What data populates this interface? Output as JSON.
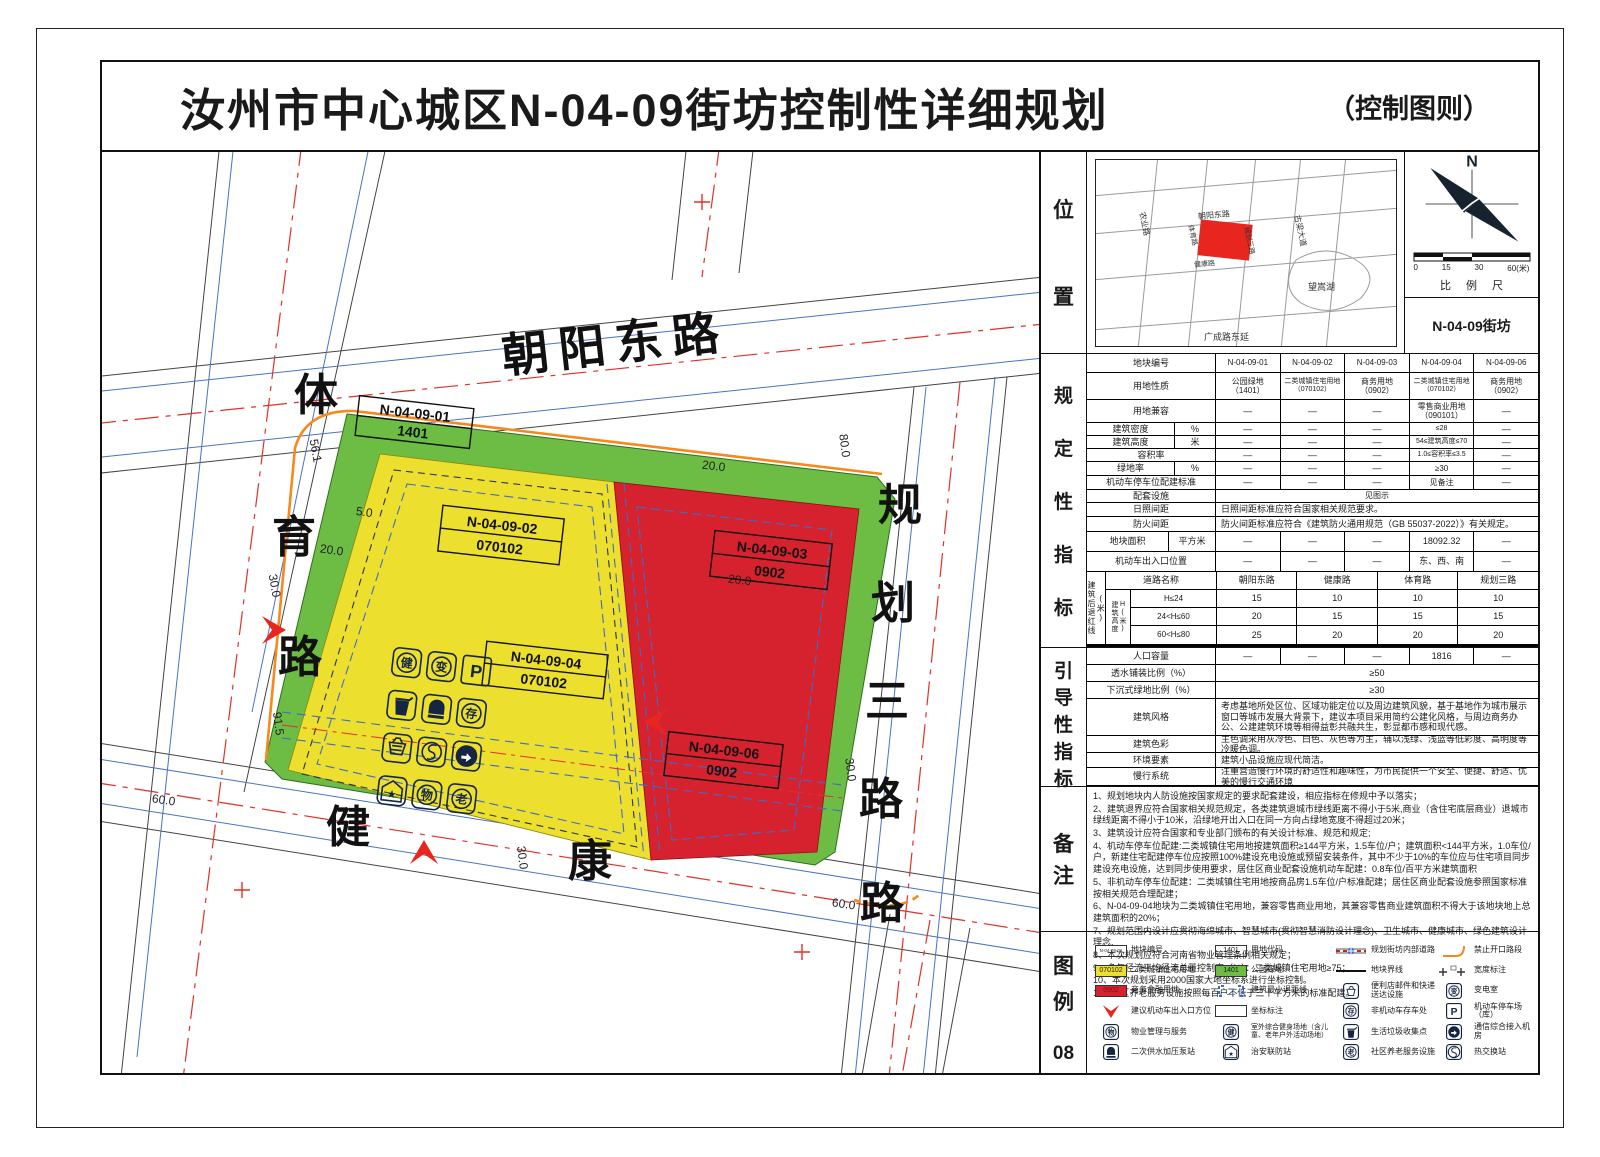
{
  "sheet": {
    "title": "汝州市中心城区N-04-09街坊控制性详细规划",
    "subtitle": "（控制图则）",
    "page_number": "08"
  },
  "map": {
    "road_north": "朝阳东路",
    "road_west_chars": [
      "体",
      "育",
      "路"
    ],
    "road_south_chars": [
      "健",
      "康",
      "路"
    ],
    "road_east_chars": [
      "规",
      "划",
      "三",
      "路"
    ],
    "parcels": [
      {
        "code": "N-04-09-01",
        "use": "1401"
      },
      {
        "code": "N-04-09-02",
        "use": "070102"
      },
      {
        "code": "N-04-09-03",
        "use": "0902"
      },
      {
        "code": "N-04-09-04",
        "use": "070102"
      },
      {
        "code": "N-04-09-06",
        "use": "0902"
      }
    ],
    "dims": [
      "80.0",
      "20.0",
      "20.0",
      "30.0",
      "60.0",
      "30.0",
      "60.0",
      "30.0",
      "20.0",
      "91.5",
      "56.1",
      "5.0"
    ],
    "icon_glyphs": {
      "fitness": "健",
      "transformer": "变",
      "parking": "P",
      "bike": "存",
      "property": "物",
      "elderly": "老",
      "star": "★"
    }
  },
  "location": {
    "label_chars": [
      "位",
      "置"
    ],
    "minimap": {
      "nongye": "农业路",
      "chaoyang": "朝阳东路",
      "tiyu": "体育路",
      "jiankang": "健康路",
      "guihua": "规划三路",
      "guliang": "古梁大道",
      "lake": "望嵩湖",
      "guangcheng": "广成路东延"
    },
    "compass_n": "N",
    "scale_ticks": [
      "0",
      "15",
      "30",
      "60(米)"
    ],
    "scale_label": "比 例 尺",
    "block_name": "N-04-09街坊"
  },
  "regulatory": {
    "label_chars": [
      "规",
      "定",
      "性",
      "指",
      "标"
    ],
    "plot_no": {
      "label": "地块编号",
      "values": [
        "N-04-09-01",
        "N-04-09-02",
        "N-04-09-03",
        "N-04-09-04",
        "N-04-09-06"
      ]
    },
    "land_use": {
      "label": "用地性质",
      "values": [
        "公园绿地\n（1401）",
        "二类城镇住宅用地\n（070102）",
        "商务用地\n（0902）",
        "二类城镇住宅用地\n（070102）",
        "商务用地\n（0902）"
      ]
    },
    "compat": {
      "label": "用地兼容",
      "values": [
        "—",
        "—",
        "—",
        "零售商业用地\n（090101）",
        "—"
      ]
    },
    "density": {
      "label": "建筑密度",
      "unit": "%",
      "values": [
        "—",
        "—",
        "—",
        "≤28",
        "—"
      ]
    },
    "height": {
      "label": "建筑高度",
      "unit": "米",
      "values": [
        "—",
        "—",
        "—",
        "54≤建筑高度≤70",
        "—"
      ]
    },
    "far": {
      "label": "容积率",
      "values": [
        "—",
        "—",
        "—",
        "1.0≤容积率≤3.5",
        "—"
      ]
    },
    "green": {
      "label": "绿地率",
      "unit": "%",
      "values": [
        "—",
        "—",
        "—",
        "≥30",
        "—"
      ]
    },
    "parking": {
      "label": "机动车停车位配建标准",
      "values": [
        "—",
        "—",
        "—",
        "见备注",
        "—"
      ]
    },
    "facilities": {
      "label": "配套设施",
      "value": "见图示"
    },
    "sunlight": {
      "label": "日照间距",
      "value": "日照间距标准应符合国家相关规范要求。"
    },
    "fire": {
      "label": "防火间距",
      "value": "防火间距标准应符合《建筑防火通用规范（GB 55037-2022）》有关规定。"
    },
    "area": {
      "label": "地块面积",
      "unit": "平方米",
      "values": [
        "—",
        "—",
        "—",
        "18092.32",
        "—"
      ]
    },
    "entrance": {
      "label": "机动车出入口位置",
      "values": [
        "—",
        "—",
        "—",
        "东、西、南",
        "—"
      ]
    },
    "setback": {
      "outer_label": "建筑后退红线(米)",
      "height_label": "建筑高度H(米)",
      "road_header": "道路名称",
      "roads": [
        "朝阳东路",
        "健康路",
        "体育路",
        "规划三路"
      ],
      "rows": [
        {
          "range": "H≤24",
          "values": [
            "15",
            "10",
            "10",
            "10"
          ]
        },
        {
          "range": "24<H≤60",
          "values": [
            "20",
            "15",
            "15",
            "15"
          ]
        },
        {
          "range": "60<H≤80",
          "values": [
            "25",
            "20",
            "20",
            "20"
          ]
        }
      ]
    }
  },
  "guidance": {
    "label_chars": [
      "引",
      "导",
      "性",
      "指",
      "标"
    ],
    "population": {
      "label": "人口容量",
      "values": [
        "—",
        "—",
        "—",
        "1816",
        "—"
      ]
    },
    "permeable": {
      "label": "透水铺装比例（%）",
      "value": "≥50"
    },
    "sunken": {
      "label": "下沉式绿地比例（%）",
      "value": "≥30"
    },
    "style": {
      "label": "建筑风格",
      "value": "考虑基地所处区位、区域功能定位以及周边建筑风貌，基于基地作为城市展示窗口等城市发展大背景下，建议本项目采用简约公建化风格，与周边商务办公、公建建筑环境等相得益彰共融共生，彰显都市感和现代感。"
    },
    "color": {
      "label": "建筑色彩",
      "value": "主色调采用灰冷色、白色、灰色等为主，辅以浅绿、浅蓝等低彩度、高明度等冷暖色调。"
    },
    "environment": {
      "label": "环境要素",
      "value": "建筑小品设施应现代简洁。"
    },
    "slow": {
      "label": "慢行系统",
      "value": "注重营造慢行环境的舒适性和趣味性，为市民提供一个安全、便捷、舒适、优美的慢行交通环境"
    }
  },
  "notes": {
    "label_chars": [
      "备",
      "注"
    ],
    "items": [
      "1、规划地块内人防设施按国家规定的要求配套建设，相应指标在修规中予以落实；",
      "2、建筑退界应符合国家相关规范规定，各类建筑退城市绿线距离不得小于5米,商业（含住宅底层商业）退城市绿线距离不得小于10米，沿绿地开出入口在同一方向占绿地宽度不得超过20米；",
      "3、建筑设计应符合国家和专业部门颁布的有关设计标准、规范和规定;",
      "4、机动车停车位配建:二类城镇住宅用地按建筑面积≥144平方米，1.5车位/户；建筑面积<144平方米，1.0车位/户，新建住宅配建停车位应按照100%建设充电设施或预留安装条件，其中不少于10%的车位应与住宅项目同步建设充电设施，达到同步使用要求，居住区商业配套设施机动车配建：0.8车位/百平方米建筑面积",
      "5、非机动车停车位配建：二类城镇住宅用地按商品房1.5车位/户标准配建；居住区商业配套设施参照国家标准按相关规范合理配建；",
      "6、N-04-09-04地块为二类城镇住宅用地，兼容零售商业用地，其兼容零售商业建筑面积不得大于该地块地上总建筑面积的20%；",
      "7、规划范围内设计应贯彻海绵城市、智慧城市(贯彻智慧消防设计理念)、卫生城市、健康城市、绿色建筑设计理念.",
      "8、本次规划应符合河南省物业管理条例相关规定；",
      "9、多年径流平均径流总量控制率（%）：二类城镇住宅用地≥75；",
      "10、本次规划采用2000国家大地坐标系进行坐标控制。",
      "11、社区养老服务设施按照每百户不低于三十平方米的标准配建。"
    ]
  },
  "legend": {
    "label_chars": [
      "图",
      "例"
    ],
    "swatches": {
      "plot": "N-04-09-01",
      "res": "070102",
      "biz": "0902",
      "code": "1401",
      "park": "1401",
      "setback": "二"
    },
    "items": [
      {
        "label": "地块编号"
      },
      {
        "label": "用地代码"
      },
      {
        "label": "规划街坊内部道路"
      },
      {
        "label": "禁止开口路段"
      },
      {
        "label": "二类城镇住宅用地"
      },
      {
        "label": "公园绿地"
      },
      {
        "label": "地块界线"
      },
      {
        "label": "宽度标注"
      },
      {
        "label": "商务金融用地"
      },
      {
        "label": "建筑最小退距线"
      },
      {
        "label": "便利店邮件和快递送达设施"
      },
      {
        "label": "变电室"
      },
      {
        "label": "建议机动车出入口方位"
      },
      {
        "label": "坐标标注"
      },
      {
        "label": "非机动车存车处"
      },
      {
        "label": "机动车停车场（库）"
      },
      {
        "label": "物业管理与服务"
      },
      {
        "label": "室外综合健身场地（含儿童、老年户外活动场地）"
      },
      {
        "label": "生活垃圾收集点"
      },
      {
        "label": "通信综合接入机房"
      },
      {
        "label": "二次供水加压泵站"
      },
      {
        "label": "治安联防站"
      },
      {
        "label": "社区养老服务设施"
      },
      {
        "label": "热交换站"
      }
    ]
  }
}
